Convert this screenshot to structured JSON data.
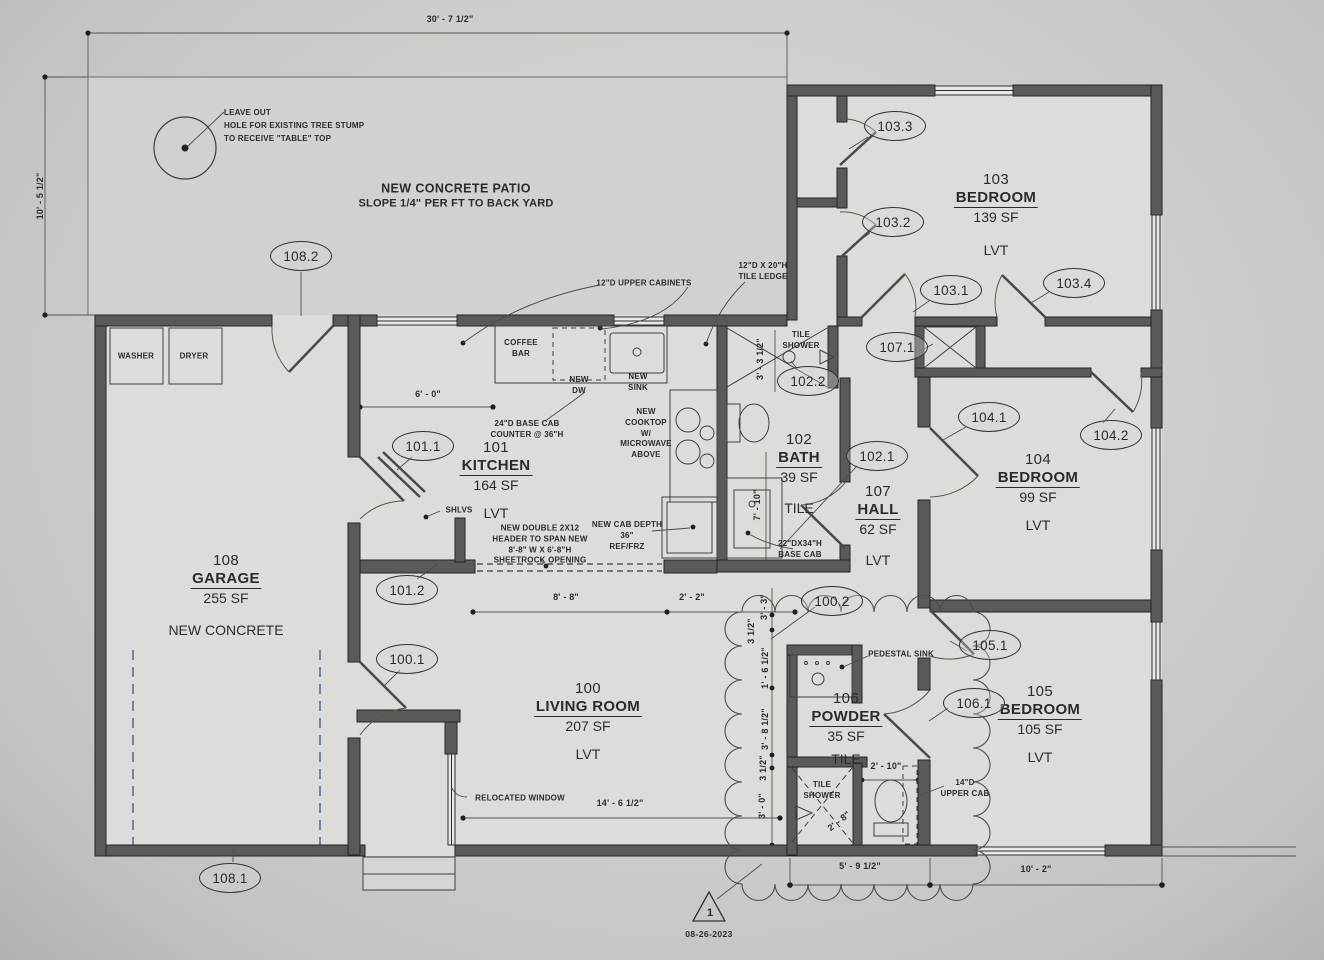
{
  "rooms": [
    {
      "number": "100",
      "name": "LIVING ROOM",
      "area": "207 SF",
      "finish": "LVT"
    },
    {
      "number": "101",
      "name": "KITCHEN",
      "area": "164 SF",
      "finish": "LVT"
    },
    {
      "number": "102",
      "name": "BATH",
      "area": "39 SF",
      "finish": "TILE"
    },
    {
      "number": "103",
      "name": "BEDROOM",
      "area": "139 SF",
      "finish": "LVT"
    },
    {
      "number": "104",
      "name": "BEDROOM",
      "area": "99 SF",
      "finish": "LVT"
    },
    {
      "number": "105",
      "name": "BEDROOM",
      "area": "105 SF",
      "finish": "LVT"
    },
    {
      "number": "106",
      "name": "POWDER",
      "area": "35 SF",
      "finish": "TILE"
    },
    {
      "number": "107",
      "name": "HALL",
      "area": "62 SF",
      "finish": "LVT"
    },
    {
      "number": "108",
      "name": "GARAGE",
      "area": "255 SF",
      "finish": "NEW CONCRETE"
    }
  ],
  "callouts": [
    {
      "label": "108.2"
    },
    {
      "label": "103.3"
    },
    {
      "label": "103.2"
    },
    {
      "label": "103.1"
    },
    {
      "label": "103.4"
    },
    {
      "label": "107.1"
    },
    {
      "label": "102.2"
    },
    {
      "label": "104.1"
    },
    {
      "label": "104.2"
    },
    {
      "label": "101.1"
    },
    {
      "label": "102.1"
    },
    {
      "label": "101.2"
    },
    {
      "label": "100.2"
    },
    {
      "label": "100.1"
    },
    {
      "label": "105.1"
    },
    {
      "label": "106.1"
    },
    {
      "label": "108.1"
    }
  ],
  "dimensions": [
    {
      "text": "30' - 7 1/2\""
    },
    {
      "text": "10' - 5 1/2\""
    },
    {
      "text": "6' - 0\""
    },
    {
      "text": "8' - 8\""
    },
    {
      "text": "2' - 2\""
    },
    {
      "text": "14' - 6 1/2\""
    },
    {
      "text": "5' - 9 1/2\""
    },
    {
      "text": "10' - 2\""
    },
    {
      "text": "2' - 10\""
    },
    {
      "text": "2' - 8\""
    },
    {
      "text": "7' - 10\""
    },
    {
      "text": "3' - 3 1/2\""
    },
    {
      "text": "3' - 3\""
    },
    {
      "text": "3 1/2\""
    },
    {
      "text": "1' - 6 1/2\""
    },
    {
      "text": "3' - 8 1/2\""
    },
    {
      "text": "3 1/2\""
    },
    {
      "text": "3' - 0\""
    }
  ],
  "annotations": [
    {
      "text": "LEAVE OUT\nHOLE FOR EXISTING TREE STUMP\nTO RECEIVE \"TABLE\" TOP"
    },
    {
      "text": "NEW CONCRETE PATIO"
    },
    {
      "text": "SLOPE 1/4\" PER FT TO BACK YARD"
    },
    {
      "text": "12\"D UPPER CABINETS"
    },
    {
      "text": "12\"D X 20\"H\nTILE LEDGE"
    },
    {
      "text": "TILE\nSHOWER"
    },
    {
      "text": "COFFEE\nBAR"
    },
    {
      "text": "NEW\nDW"
    },
    {
      "text": "NEW\nSINK"
    },
    {
      "text": "NEW\nCOOKTOP\nW/\nMICROWAVE\nABOVE"
    },
    {
      "text": "24\"D BASE CAB\nCOUNTER @ 36\"H"
    },
    {
      "text": "SHLVS"
    },
    {
      "text": "NEW DOUBLE 2X12\nHEADER TO SPAN NEW\n8'-8\" W X 6'-8\"H\nSHEETROCK OPENING"
    },
    {
      "text": "NEW CAB DEPTH\n36\"\nREF/FRZ"
    },
    {
      "text": "22\"DX34\"H\nBASE CAB"
    },
    {
      "text": "PEDESTAL SINK"
    },
    {
      "text": "RELOCATED WINDOW"
    },
    {
      "text": "TILE\nSHOWER"
    },
    {
      "text": "14\"D\nUPPER CAB"
    },
    {
      "text": "WASHER"
    },
    {
      "text": "DRYER"
    }
  ],
  "marker": {
    "label": "1",
    "date": "08-26-2023"
  },
  "colors": {
    "wall": "#5a5a57",
    "paper": "#d0cfcc",
    "slab_dash": "#7a7eb0",
    "ink": "#2c2b29"
  }
}
